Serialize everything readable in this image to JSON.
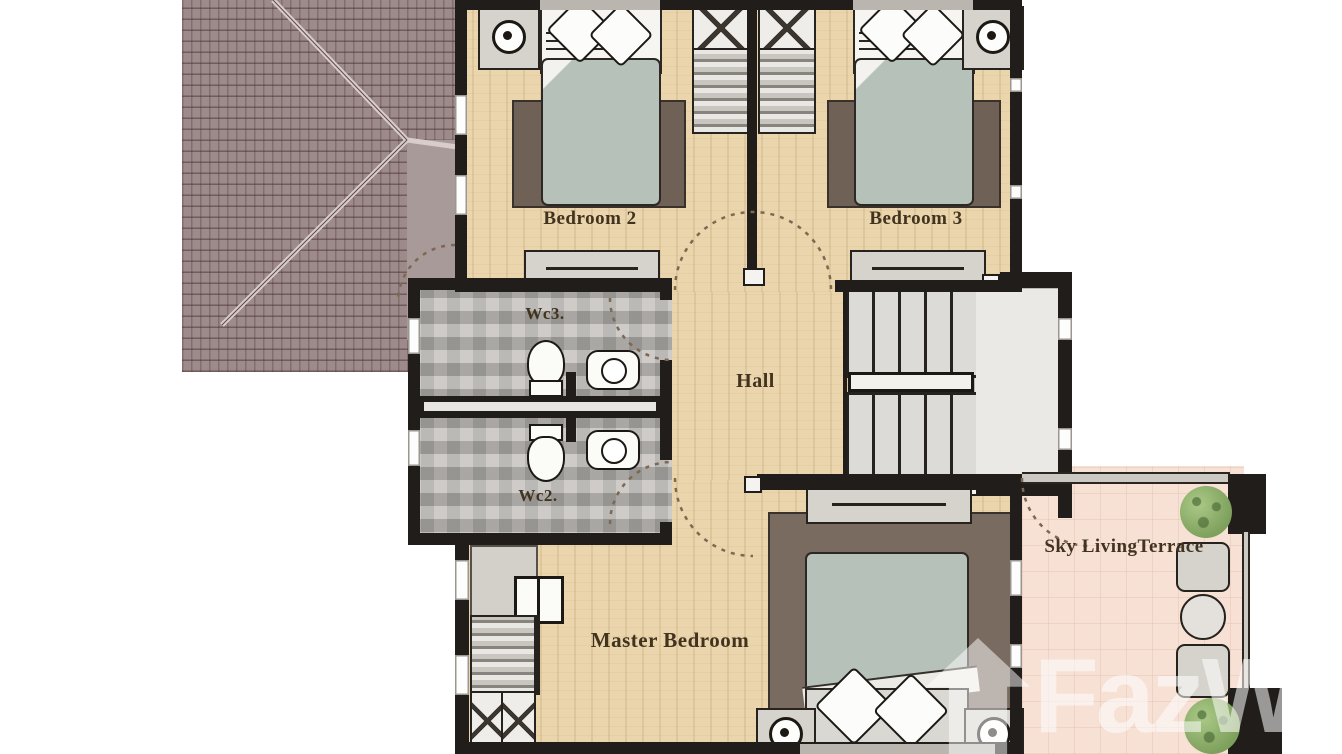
{
  "rooms": {
    "bedroom2": "Bedroom 2",
    "bedroom3": "Bedroom 3",
    "hall": "Hall",
    "wc3": "Wc3.",
    "wc2": "Wc2.",
    "master_bedroom": "Master Bedroom",
    "terrace": "Sky LivingTerrace"
  },
  "watermark": {
    "text": "FazWa"
  },
  "colors": {
    "wall": "#211d1a",
    "wood_floor": "#ebd5ad",
    "tile_floor": "#b2afaa",
    "terrace_floor": "#f7e0d4",
    "roof": "#9d8a8a",
    "bed_duvet": "#b6c1b9",
    "rug": "#6f6156",
    "plant": "#93b872",
    "stair_landing": "#eae9e6",
    "watermark": "rgba(255,255,255,0.55)"
  },
  "icons": [
    "lamp-icon",
    "toilet-icon",
    "sink-icon",
    "plant-icon",
    "house-watermark-icon",
    "stairs",
    "door-arc"
  ]
}
